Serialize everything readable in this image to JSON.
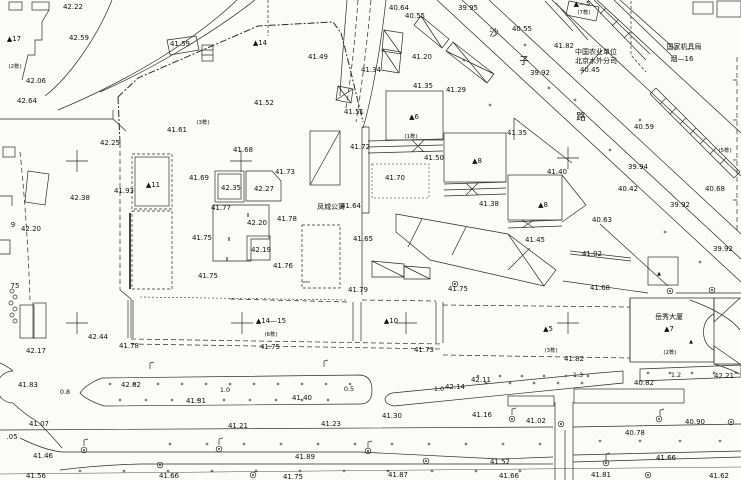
{
  "meta": {
    "width": 741,
    "height": 480,
    "kind": "topographic-survey-plan",
    "ink": "#2b2b2b",
    "bg": "#fbfbfa"
  },
  "labels": [
    [
      "42.22",
      73,
      9
    ],
    [
      "42.59",
      79,
      40
    ],
    [
      "42.06",
      36,
      83
    ],
    [
      "42.64",
      27,
      103
    ],
    [
      "41.59",
      180,
      46
    ],
    [
      "41.61",
      177,
      132
    ],
    [
      "41.49",
      318,
      59
    ],
    [
      "41.52",
      264,
      105
    ],
    [
      "41.51",
      354,
      114
    ],
    [
      "42.25",
      110,
      145
    ],
    [
      "42.38",
      80,
      200
    ],
    [
      "42.20",
      31,
      231
    ],
    [
      "9",
      13,
      227
    ],
    [
      "75",
      15,
      288
    ],
    [
      "42.17",
      36,
      353
    ],
    [
      "41.93",
      124,
      193
    ],
    [
      "41.68",
      243,
      152
    ],
    [
      "41.73",
      285,
      174
    ],
    [
      "41.69",
      199,
      180
    ],
    [
      "42.35",
      231,
      190
    ],
    [
      "42.27",
      264,
      191
    ],
    [
      "41.77",
      221,
      210
    ],
    [
      "42.20",
      257,
      225
    ],
    [
      "41.78",
      287,
      221
    ],
    [
      "41.75",
      202,
      240
    ],
    [
      "42.19",
      261,
      252
    ],
    [
      "41.76",
      283,
      268
    ],
    [
      "41.75",
      208,
      278
    ],
    [
      "41.64",
      351,
      208
    ],
    [
      "41.65",
      363,
      241
    ],
    [
      "40.64",
      399,
      10
    ],
    [
      "40.55",
      415,
      18
    ],
    [
      "39.95",
      468,
      10
    ],
    [
      "41.34",
      371,
      72
    ],
    [
      "41.20",
      422,
      59
    ],
    [
      "41.35",
      423,
      88
    ],
    [
      "41.29",
      456,
      92
    ],
    [
      "41.72",
      360,
      149
    ],
    [
      "41.50",
      434,
      160
    ],
    [
      "41.70",
      395,
      180
    ],
    [
      "41.35",
      517,
      135
    ],
    [
      "41.40",
      557,
      174
    ],
    [
      "41.38",
      489,
      206
    ],
    [
      "41.45",
      535,
      242
    ],
    [
      "39.92",
      540,
      75
    ],
    [
      "40.45",
      590,
      72
    ],
    [
      "40.55",
      522,
      31
    ],
    [
      "41.82",
      564,
      48
    ],
    [
      "40.59",
      644,
      129
    ],
    [
      "39.94",
      638,
      169
    ],
    [
      "40.42",
      628,
      191
    ],
    [
      "40.68",
      715,
      191
    ],
    [
      "39.92",
      680,
      207
    ],
    [
      "39.92",
      723,
      251
    ],
    [
      "40.63",
      602,
      222
    ],
    [
      "41.02",
      592,
      256
    ],
    [
      "41.68",
      600,
      290
    ],
    [
      "41.79",
      358,
      292
    ],
    [
      "41.75",
      458,
      291
    ],
    [
      "41.75",
      270,
      349
    ],
    [
      "41.73",
      424,
      352
    ],
    [
      "41.82",
      574,
      361
    ],
    [
      "40.82",
      644,
      385
    ],
    [
      "42.21",
      724,
      378
    ],
    [
      "42.11",
      481,
      382
    ],
    [
      "42.14",
      455,
      389
    ],
    [
      "41.40",
      302,
      400
    ],
    [
      "42.02",
      131,
      387
    ],
    [
      "41.31",
      196,
      403
    ],
    [
      "41.83",
      28,
      387
    ],
    [
      "42.44",
      98,
      339
    ],
    [
      "41.78",
      129,
      348
    ],
    [
      "41.30",
      392,
      418
    ],
    [
      "41.16",
      482,
      417
    ],
    [
      "41.02",
      536,
      423
    ],
    [
      "40.90",
      695,
      424
    ],
    [
      "40.78",
      635,
      435
    ],
    [
      "41.07",
      39,
      426
    ],
    [
      "41.21",
      238,
      428
    ],
    [
      "41.23",
      331,
      426
    ],
    [
      ".05",
      12,
      439
    ],
    [
      "41.46",
      43,
      458
    ],
    [
      "41.89",
      305,
      459
    ],
    [
      "41.52",
      500,
      464
    ],
    [
      "41.66",
      666,
      460
    ],
    [
      "41.56",
      36,
      478
    ],
    [
      "41.66",
      169,
      478
    ],
    [
      "41.75",
      293,
      479
    ],
    [
      "41.87",
      398,
      477
    ],
    [
      "41.66",
      509,
      478
    ],
    [
      "41.81",
      601,
      477
    ],
    [
      "41.62",
      719,
      478
    ],
    [
      "▲17",
      14,
      41,
      "bldg"
    ],
    [
      "▲14",
      260,
      45,
      "bldg"
    ],
    [
      "▲11",
      153,
      187,
      "bldg"
    ],
    [
      "▲6",
      414,
      119,
      "bldg"
    ],
    [
      "▲8",
      477,
      163,
      "bldg"
    ],
    [
      "▲8",
      543,
      207,
      "bldg"
    ],
    [
      "▲14—15",
      271,
      323,
      "bldg"
    ],
    [
      "▲10",
      391,
      323,
      "bldg"
    ],
    [
      "▲5",
      548,
      331,
      "bldg"
    ],
    [
      "▲7",
      669,
      331,
      "bldg"
    ],
    [
      "▲—5",
      582,
      6,
      "bldg"
    ],
    [
      "(2栋)",
      15,
      68,
      "note"
    ],
    [
      "(3栋)",
      203,
      124,
      "note"
    ],
    [
      "(1栋)",
      411,
      138,
      "note"
    ],
    [
      "(7栋)",
      584,
      14,
      "note"
    ],
    [
      "(5栋)",
      725,
      152,
      "note"
    ],
    [
      "(6栋)",
      271,
      336,
      "note"
    ],
    [
      "(3栋)",
      551,
      352,
      "note"
    ],
    [
      "(2栋)",
      670,
      354,
      "note"
    ],
    [
      "凤城公寓",
      331,
      209,
      "name"
    ],
    [
      "岳秀大厦",
      669,
      319,
      "name"
    ],
    [
      "中国农业单位",
      596,
      54,
      "name"
    ],
    [
      "北京水外分司",
      596,
      63,
      "name"
    ],
    [
      "国家机具局",
      684,
      49,
      "name"
    ],
    [
      "烟—16",
      682,
      61,
      "name"
    ],
    [
      "沙",
      494,
      36,
      "street"
    ],
    [
      "子",
      524,
      64,
      "street"
    ],
    [
      "路",
      581,
      120,
      "street"
    ],
    [
      "0.8",
      65,
      394,
      "dim"
    ],
    [
      "1.0",
      225,
      392,
      "dim"
    ],
    [
      "0.5",
      349,
      391,
      "dim"
    ],
    [
      "1.0",
      439,
      391,
      "dim"
    ],
    [
      "1.3",
      578,
      377,
      "dim"
    ],
    [
      "1.2",
      676,
      377,
      "dim"
    ],
    [
      "II",
      248,
      217,
      "mark"
    ],
    [
      "II",
      229,
      241,
      "mark"
    ],
    [
      "II",
      227,
      261,
      "mark"
    ],
    [
      "▲",
      659,
      275,
      "mark"
    ],
    [
      "▲",
      691,
      343,
      "mark"
    ]
  ],
  "crosses": [
    [
      77,
      161
    ],
    [
      241,
      161
    ],
    [
      568,
      158
    ],
    [
      77,
      323
    ],
    [
      242,
      323
    ],
    [
      406,
      323
    ],
    [
      568,
      323
    ]
  ],
  "trees": [
    [
      84,
      450
    ],
    [
      219,
      449
    ],
    [
      368,
      451
    ],
    [
      426,
      461
    ],
    [
      512,
      419
    ],
    [
      561,
      424
    ],
    [
      606,
      463
    ],
    [
      659,
      419
    ],
    [
      731,
      422
    ],
    [
      253,
      475
    ],
    [
      160,
      465
    ],
    [
      455,
      284
    ],
    [
      670,
      291
    ],
    [
      712,
      290
    ],
    [
      648,
      475
    ]
  ],
  "poles": [
    [
      150,
      369
    ],
    [
      324,
      367
    ],
    [
      84,
      446
    ],
    [
      219,
      445
    ],
    [
      368,
      448
    ],
    [
      512,
      415
    ],
    [
      606,
      460
    ],
    [
      660,
      416
    ]
  ],
  "shrubs": [
    [
      12,
      291
    ],
    [
      15,
      297
    ],
    [
      11,
      303
    ],
    [
      15,
      309
    ],
    [
      12,
      315
    ],
    [
      15,
      321
    ]
  ],
  "dot_rows": [
    {
      "y": 384,
      "x0": 110,
      "x1": 350,
      "step": 24
    },
    {
      "y": 400,
      "x0": 120,
      "x1": 350,
      "step": 26
    },
    {
      "y": 376,
      "x0": 478,
      "x1": 592,
      "step": 22
    },
    {
      "y": 383,
      "x0": 486,
      "x1": 592,
      "step": 24
    },
    {
      "y": 373,
      "x0": 648,
      "x1": 736,
      "step": 22
    },
    {
      "y": 444,
      "x0": 170,
      "x1": 540,
      "step": 37
    },
    {
      "y": 441,
      "x0": 600,
      "x1": 730,
      "step": 40
    },
    {
      "y": 471,
      "x0": 80,
      "x1": 520,
      "step": 44
    }
  ],
  "dots": [
    [
      575,
      100
    ],
    [
      549,
      88
    ],
    [
      610,
      150
    ],
    [
      640,
      120
    ],
    [
      525,
      45
    ],
    [
      665,
      232
    ],
    [
      700,
      262
    ],
    [
      464,
      60
    ],
    [
      490,
      105
    ]
  ]
}
